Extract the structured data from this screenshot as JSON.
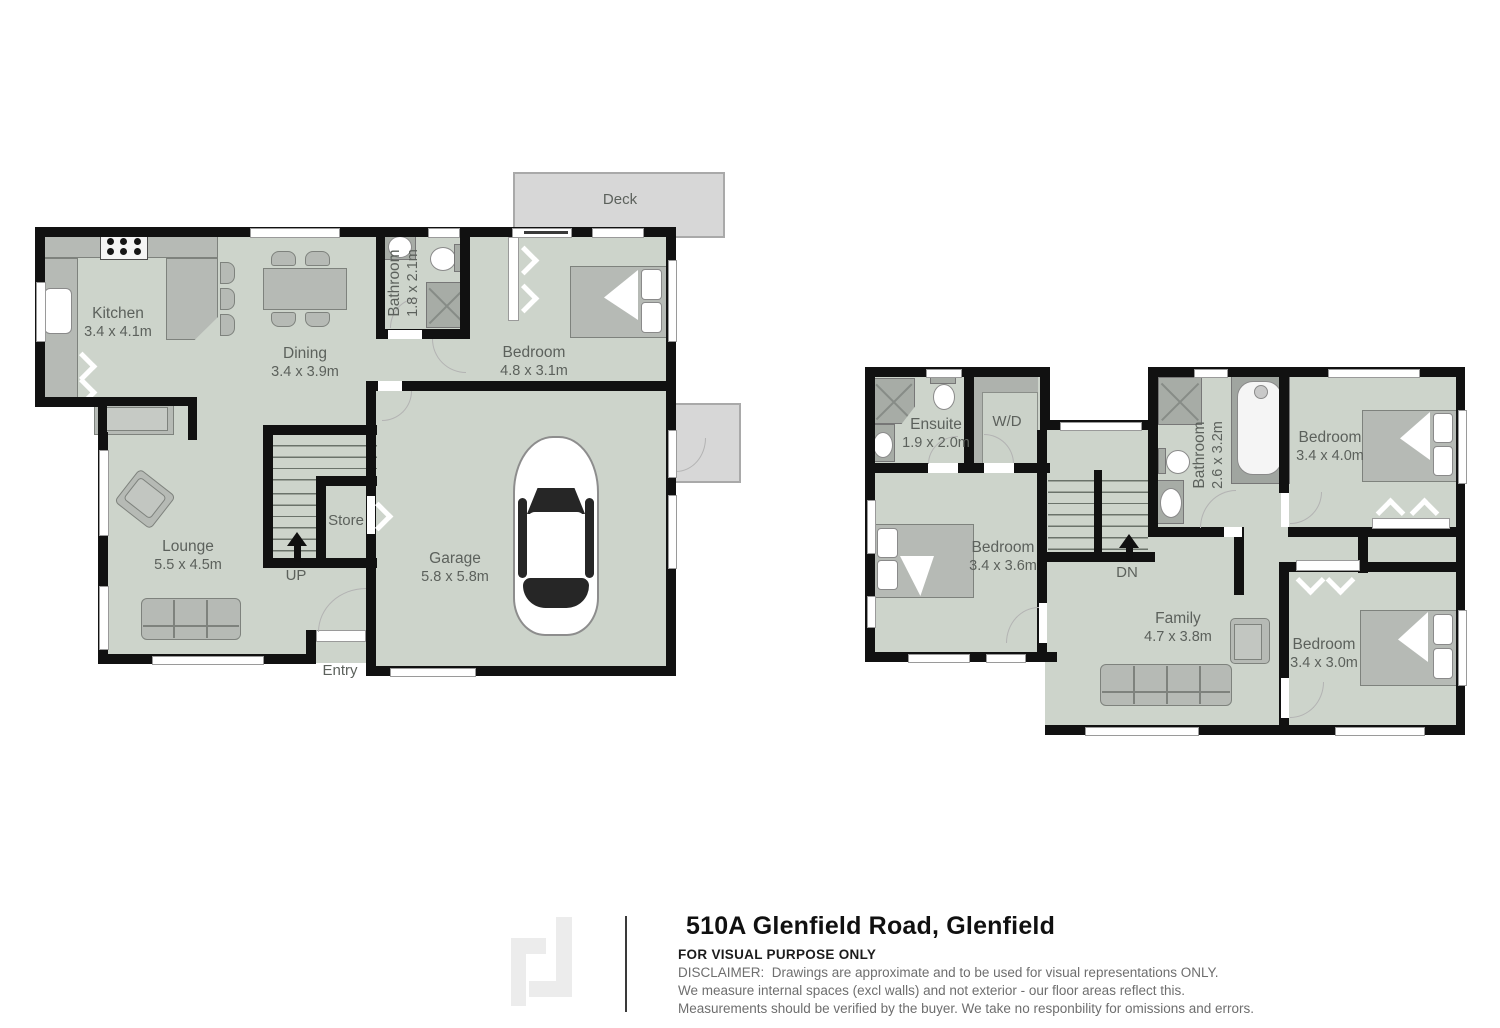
{
  "floorplan": {
    "ground": {
      "deck": "Deck",
      "kitchen": {
        "name": "Kitchen",
        "dims": "3.4 x 4.1m"
      },
      "dining": {
        "name": "Dining",
        "dims": "3.4 x 3.9m"
      },
      "bathroom": {
        "name": "Bathroom",
        "dims": "1.8 x 2.1m"
      },
      "bedroom": {
        "name": "Bedroom",
        "dims": "4.8 x 3.1m"
      },
      "lounge": {
        "name": "Lounge",
        "dims": "5.5 x 4.5m"
      },
      "store": "Store",
      "garage": {
        "name": "Garage",
        "dims": "5.8 x 5.8m"
      },
      "up": "UP",
      "entry": "Entry"
    },
    "upper": {
      "ensuite": {
        "name": "Ensuite",
        "dims": "1.9 x 2.0m"
      },
      "wd": "W/D",
      "bathroom": {
        "name": "Bathroom",
        "dims": "2.6 x 3.2m"
      },
      "bedroom_top": {
        "name": "Bedroom",
        "dims": "3.4 x 4.0m"
      },
      "bedroom_left": {
        "name": "Bedroom",
        "dims": "3.4 x 3.6m"
      },
      "family": {
        "name": "Family",
        "dims": "4.7 x 3.8m"
      },
      "bedroom_bottom": {
        "name": "Bedroom",
        "dims": "3.4 x 3.0m"
      },
      "down": "DN"
    }
  },
  "footer": {
    "title": "510A Glenfield Road, Glenfield",
    "purpose": "FOR VISUAL PURPOSE ONLY",
    "disclaimer1": "DISCLAIMER:  Drawings are approximate and to be used for visual representations ONLY.",
    "disclaimer2": "We measure internal spaces (excl walls) and not exterior - our floor areas reflect this.",
    "disclaimer3": "Measurements should be verified by the buyer. We take no responbility for omissions and errors."
  },
  "colors": {
    "floor": "#cdd4cb",
    "wall": "#111111",
    "deck": "#d7d7d7",
    "furniture": "#b6bab5",
    "fixture": "#a7aca6",
    "label": "#5c615c"
  }
}
